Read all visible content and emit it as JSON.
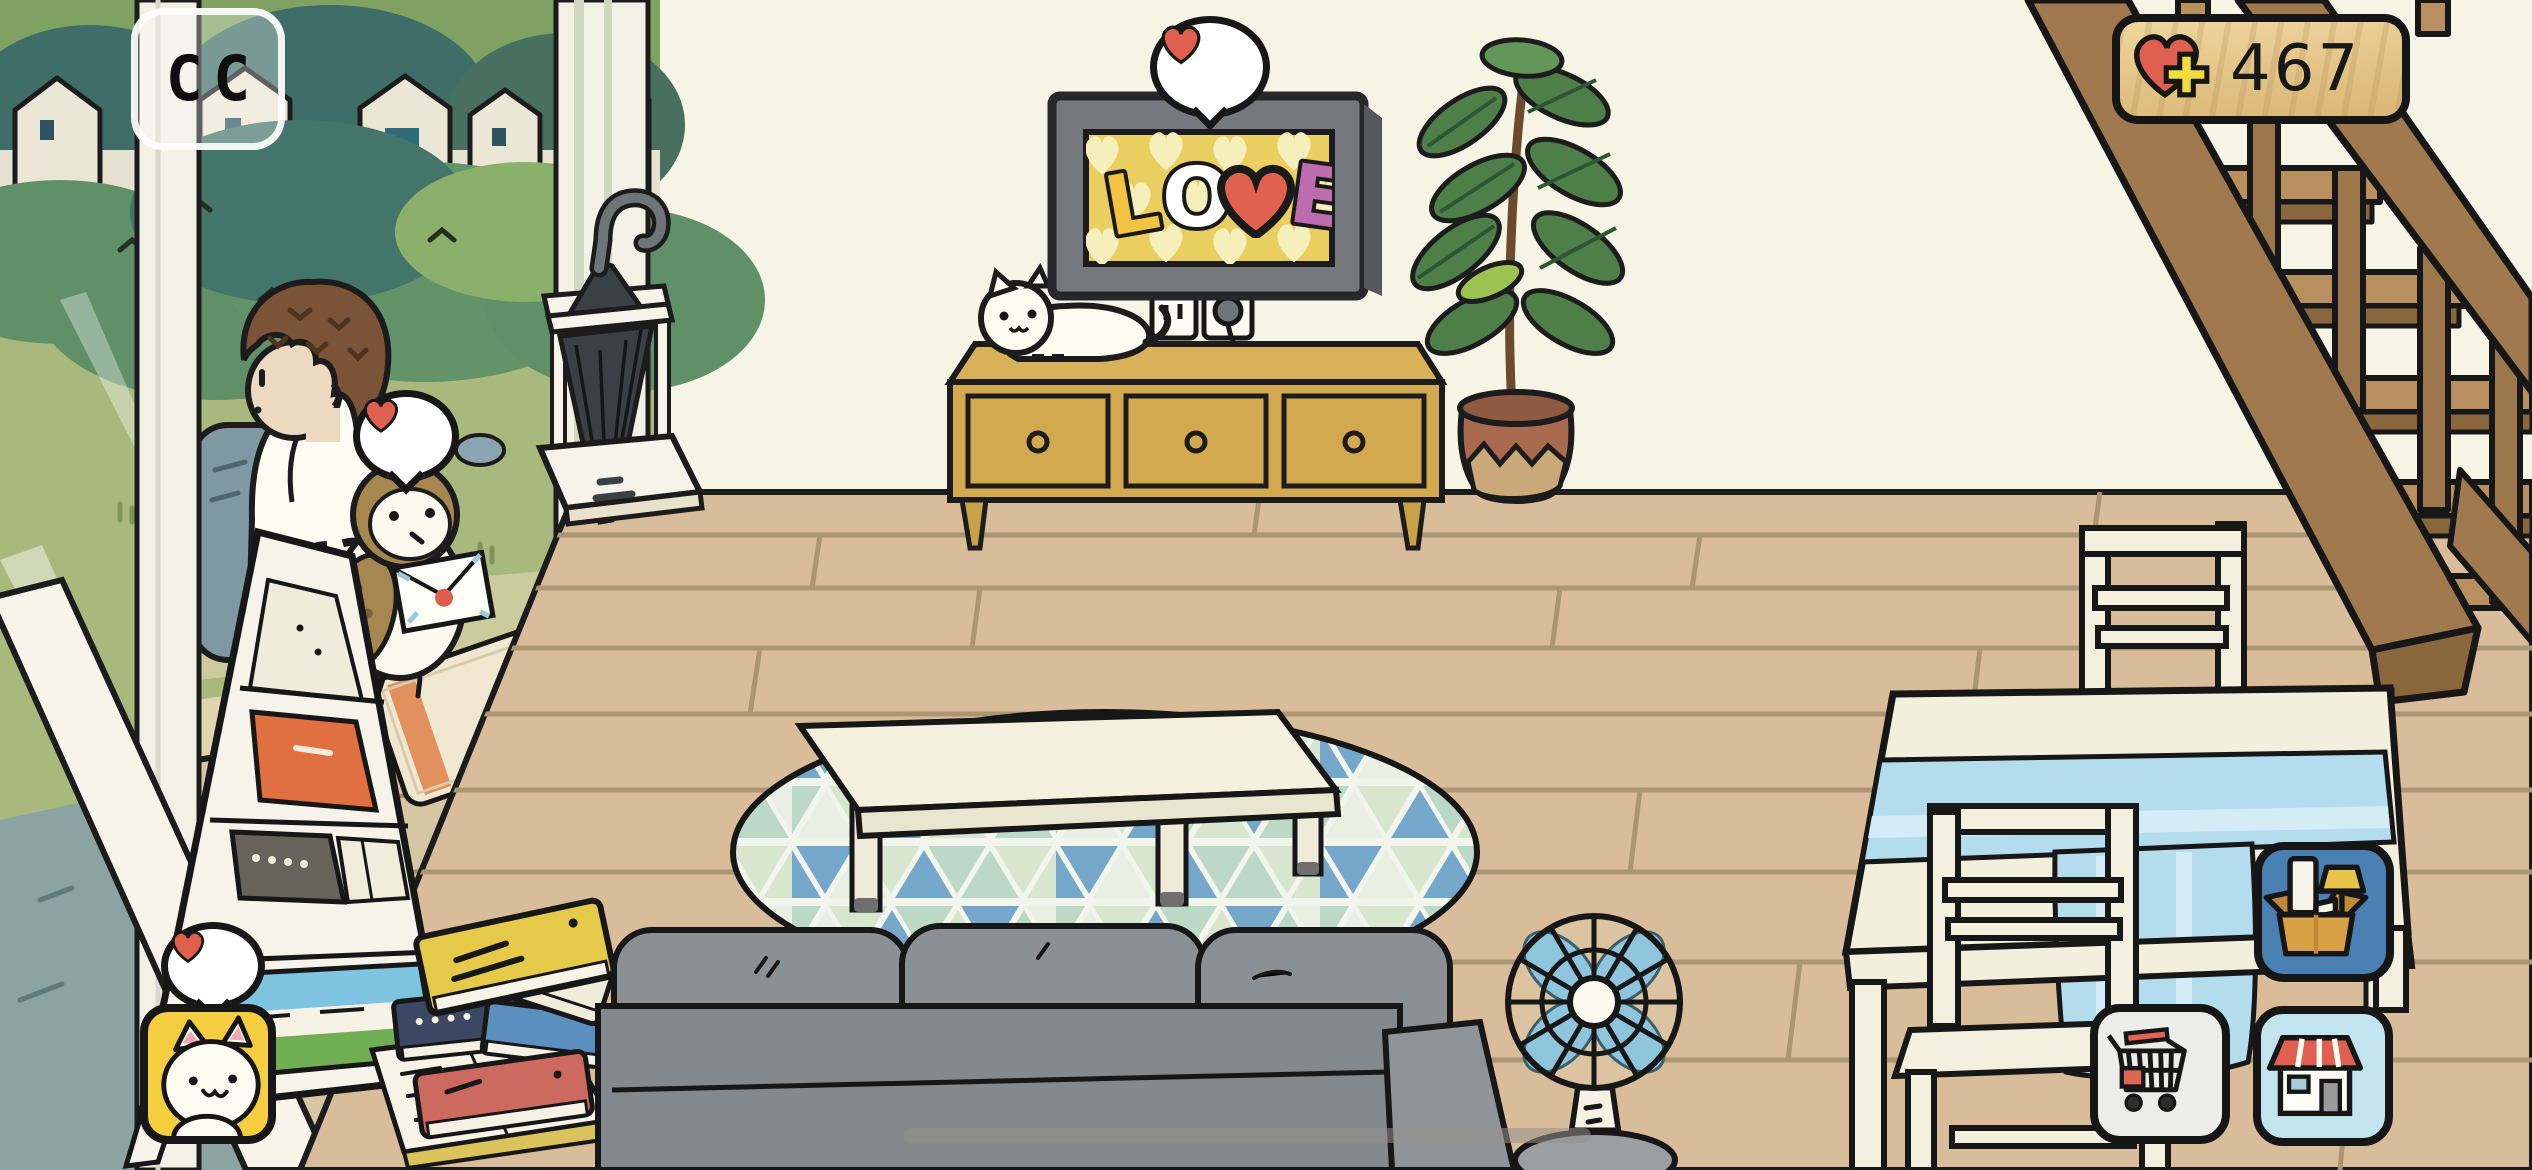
{
  "hud": {
    "hearts_counter": {
      "value": "467",
      "icon": "heart-plus-icon",
      "panel": "wooden-sign"
    },
    "observe_button": {
      "icon": "binoculars-icon",
      "glyph": "CC"
    }
  },
  "menu": {
    "decorate_button": {
      "icon": "furniture-box-icon",
      "bg_color": "#4a80b2"
    },
    "cart_button": {
      "icon": "shopping-cart-icon",
      "bg_color": "#ececea"
    },
    "shop_button": {
      "icon": "shop-house-icon",
      "bg_color": "#c2e4ef"
    }
  },
  "tv": {
    "screen_text": "LOVE",
    "letters": [
      {
        "char": "L",
        "color": "#f2c243"
      },
      {
        "char": "O",
        "color": "#ffffff"
      },
      {
        "char": "V",
        "color": "#e0614e",
        "shape": "heart"
      },
      {
        "char": "E",
        "color": "#bd6cae"
      }
    ],
    "screen_bg": "#e9cf5f",
    "pattern": "hearts"
  },
  "reactions": [
    {
      "target": "tv",
      "icon": "heart-icon"
    },
    {
      "target": "owl",
      "icon": "heart-icon"
    },
    {
      "target": "cat-photo",
      "icon": "heart-icon"
    }
  ],
  "scene": {
    "objects": [
      "sliding-door",
      "outdoor-view",
      "man-sitting",
      "travel-bag",
      "owl-with-letter",
      "floor-mat",
      "umbrella-stand",
      "magazine-rack",
      "book-stack",
      "cat-photo-sticker",
      "tv",
      "tv-stand",
      "white-cat",
      "wall-outlet",
      "potted-plant",
      "staircase",
      "round-rug",
      "coffee-table",
      "sofa",
      "electric-fan",
      "dining-table",
      "dining-chair-back",
      "dining-chair-front",
      "wood-floor",
      "home-indicator"
    ]
  },
  "colors": {
    "wall": "#f6f4e4",
    "floor": "#d9bd9a",
    "accent_heart": "#e0604f",
    "plus_yellow": "#f2dd3d",
    "wood_sign": "#e7cd93",
    "stairs_wood": "#a07a4e",
    "rug_blue": "#74a7c9",
    "tablecloth": "#b3dcec",
    "sofa_gray": "#84898d",
    "fan_blue": "#8fc4dd",
    "stand_wood": "#d2a94f"
  }
}
